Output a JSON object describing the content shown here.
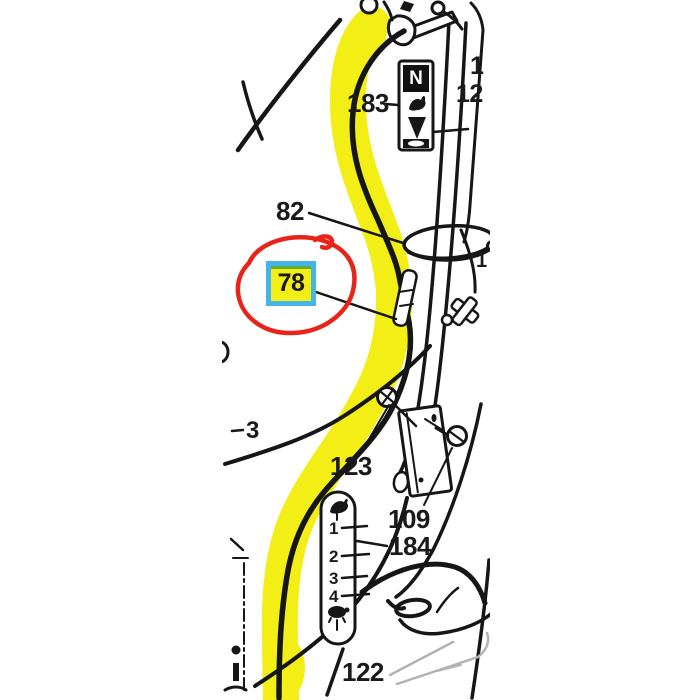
{
  "annotations": {
    "highlighter_color": "#f2ee16",
    "circle_color": "#e8231a",
    "callout_box": {
      "value": "78",
      "border_color": "#45b4e6",
      "fill_color": "#f2ee16"
    }
  },
  "part_labels": {
    "throttle_decal": "183",
    "cable_clamp": "82",
    "cable_adjuster": "78",
    "mount_bracket": "123",
    "bracket_bolt": "109",
    "scale_decal": "184",
    "lower_cable": "122",
    "partial_left": "3",
    "partial_right_top": "1",
    "partial_right_mid": "12",
    "partial_right_low": "1"
  },
  "decals": {
    "top_decal_letter": "N",
    "scale_marks": [
      "1",
      "2",
      "3",
      "4"
    ]
  },
  "colors": {
    "line": "#161616",
    "light_line": "#b2b2b2",
    "background": "#ffffff"
  }
}
